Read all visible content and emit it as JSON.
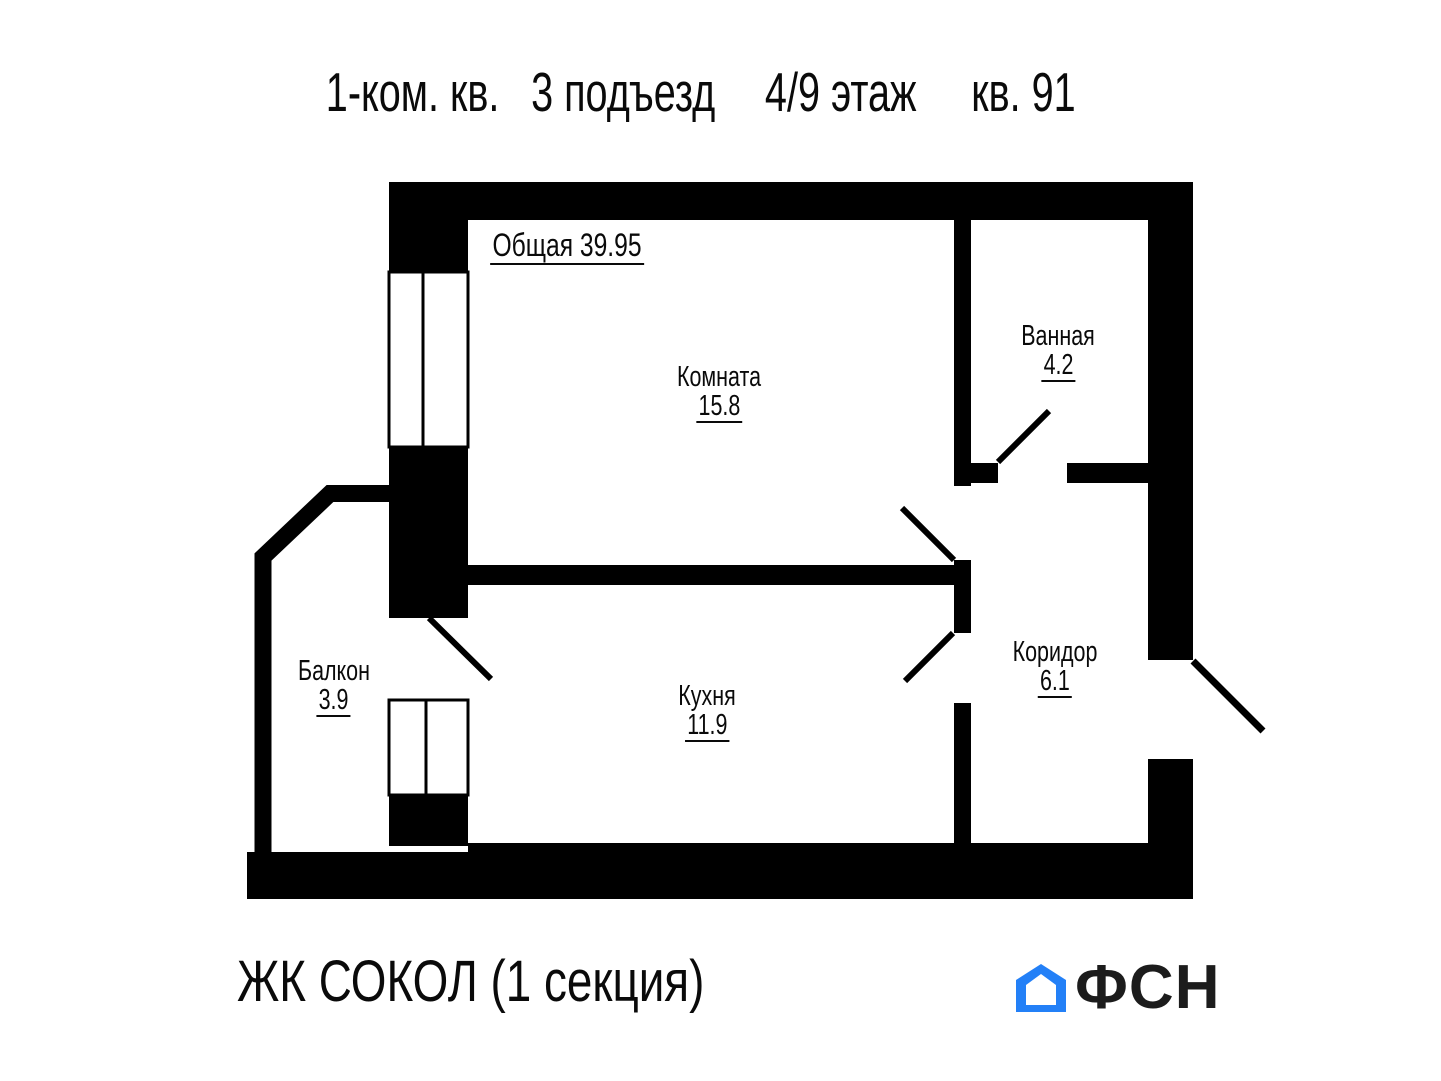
{
  "title": {
    "segments": [
      "1-ком. кв.",
      "3 подъезд",
      "4/9 этаж",
      "кв. 91"
    ]
  },
  "plan": {
    "total_label": "Общая",
    "total_area": "39.95",
    "rooms": [
      {
        "name": "Комната",
        "area": "15.8"
      },
      {
        "name": "Ванная",
        "area": "4.2"
      },
      {
        "name": "Коридор",
        "area": "6.1"
      },
      {
        "name": "Кухня",
        "area": "11.9"
      },
      {
        "name": "Балкон",
        "area": "3.9"
      }
    ]
  },
  "footer": {
    "complex_name": "ЖК СОКОЛ (1 секция)",
    "logo": {
      "text": "ФСН",
      "icon": "house-icon",
      "icon_color": "#2380f7",
      "text_color": "#1c1c1c"
    }
  },
  "colors": {
    "background": "#ffffff",
    "walls": "#000000"
  }
}
